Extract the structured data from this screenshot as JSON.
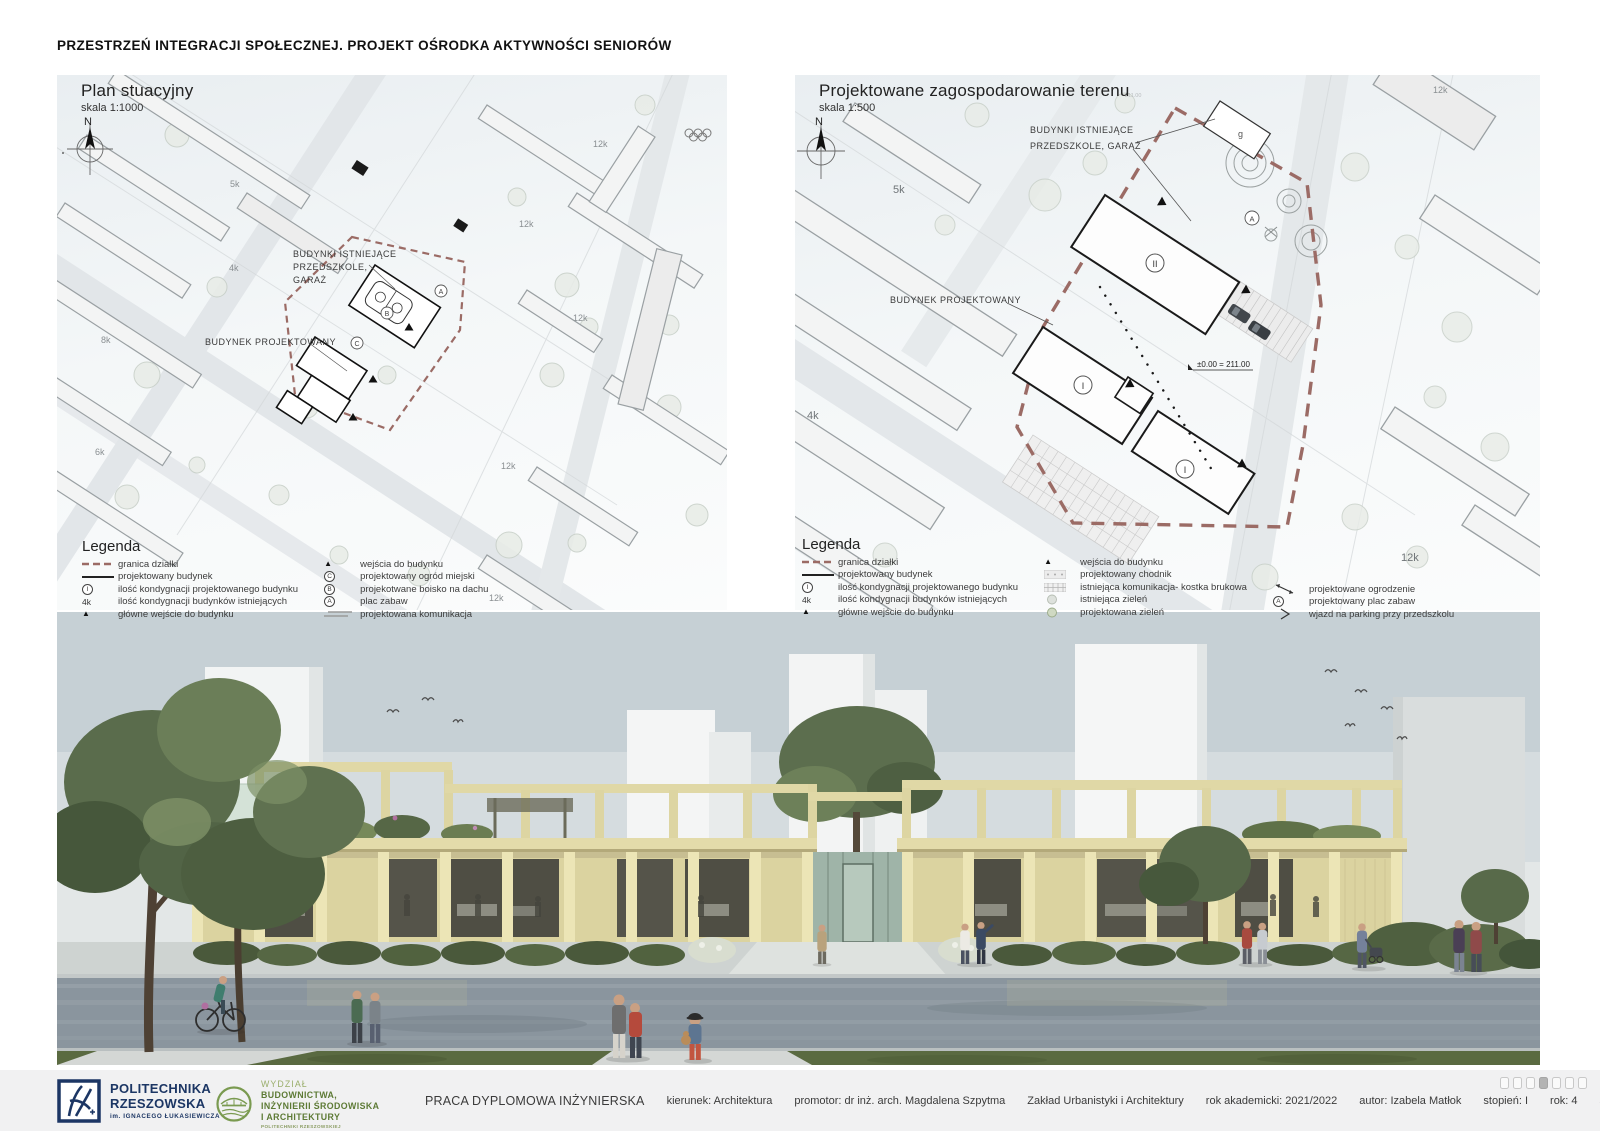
{
  "title": "PRZESTRZEŃ INTEGRACJI SPOŁECZNEJ. PROJEKT OŚRODKA AKTYWNOŚCI SENIORÓW",
  "symbols": {
    "triangle": "▲",
    "chevron": "›"
  },
  "maps": {
    "left": {
      "title": "Plan stuacyjny",
      "scale": "skala 1:1000",
      "north": "N",
      "label_existing_1": "BUDYNKI ISTNIEJĄCE",
      "label_existing_2": "PRZEDSZKOLE,",
      "label_existing_3": "GARAŻ",
      "label_proposed": "BUDYNEK PROJEKTOWANY",
      "small": {
        "k5": "5k",
        "k4": "4k",
        "k8": "8k",
        "k6": "6k",
        "k12": "12k"
      },
      "circ": {
        "a": "A",
        "b": "B",
        "c": "C"
      }
    },
    "right": {
      "title": "Projektowane zagospodarowanie terenu",
      "scale": "skala 1:500",
      "north": "N",
      "label_existing_1": "BUDYNKI ISTNIEJĄCE",
      "label_existing_2": "PRZEDSZKOLE, GARAŻ",
      "label_proposed": "BUDYNEK PROJEKTOWANY",
      "small": {
        "k5": "5k",
        "k4": "4k",
        "k12": "12k",
        "g": "g"
      },
      "level": "±0.00 = 211.00",
      "elev": "211.00",
      "circ": {
        "a": "A",
        "one": "I",
        "two": "II"
      }
    }
  },
  "legend_left": {
    "title": "Legenda",
    "col1": [
      {
        "label": "granica działki"
      },
      {
        "label": "projektowany budynek"
      },
      {
        "sym": "I",
        "label": "ilość kondygnacji projektowanego budynku"
      },
      {
        "sym": "4k",
        "label": "ilość kondygnacji budynków istniejących"
      },
      {
        "label": "główne wejście do budynku"
      }
    ],
    "col2": [
      {
        "label": "wejścia do budynku"
      },
      {
        "sym": "C",
        "label": "projektowany ogród miejski"
      },
      {
        "sym": "B",
        "label": "projekotwane boisko na dachu"
      },
      {
        "sym": "A",
        "label": "plac zabaw"
      },
      {
        "label": "projektowana komunikacja"
      }
    ]
  },
  "legend_right": {
    "title": "Legenda",
    "col1": [
      {
        "label": "granica działki"
      },
      {
        "label": "projektowany budynek"
      },
      {
        "sym": "I",
        "label": "ilość kondygnacji projektowanego budynku"
      },
      {
        "sym": "4k",
        "label": "ilość kondygnacji budynków istniejących"
      },
      {
        "label": "główne wejście do budynku"
      }
    ],
    "col2": [
      {
        "label": "wejścia do budynku"
      },
      {
        "label": "projektowany chodnik"
      },
      {
        "label": "istniejąca komunikacja- kostka brukowa"
      },
      {
        "label": "istniejąca zieleń"
      },
      {
        "label": "projektowana zieleń"
      }
    ],
    "col3": [
      {
        "label": "projektowane ogrodzenie"
      },
      {
        "sym": "A",
        "label": "projektowany plac zabaw"
      },
      {
        "label": "wjazd na parking przy przedszkolu"
      }
    ]
  },
  "footer": {
    "logo_prz": {
      "line1": "POLITECHNIKA",
      "line2": "RZESZOWSKA",
      "line3": "im. IGNACEGO ŁUKASIEWICZA"
    },
    "logo_wbisia": {
      "line0": "WYDZIAŁ",
      "line1": "BUDOWNICTWA,",
      "line2": "INŻYNIERII ŚRODOWISKA",
      "line3": "I ARCHITEKTURY",
      "line4": "POLITECHNIKI RZESZOWSKIEJ"
    },
    "info": [
      "PRACA DYPLOMOWA INŻYNIERSKA",
      "kierunek: Architektura",
      "promotor: dr inż. arch. Magdalena Szpytma",
      "Zakład Urbanistyki i Architektury",
      "rok akademicki: 2021/2022",
      "autor: Izabela Matłok",
      "stopień: I",
      "rok: 4",
      "semestr: 7"
    ],
    "pages_total": 7,
    "active_page": 4
  },
  "colors": {
    "boundary": "#9b6b65",
    "navy": "#1c3664",
    "green": "#5d7a35",
    "footer_bg": "#f1f1f2",
    "timber": "#dbd3a0"
  }
}
